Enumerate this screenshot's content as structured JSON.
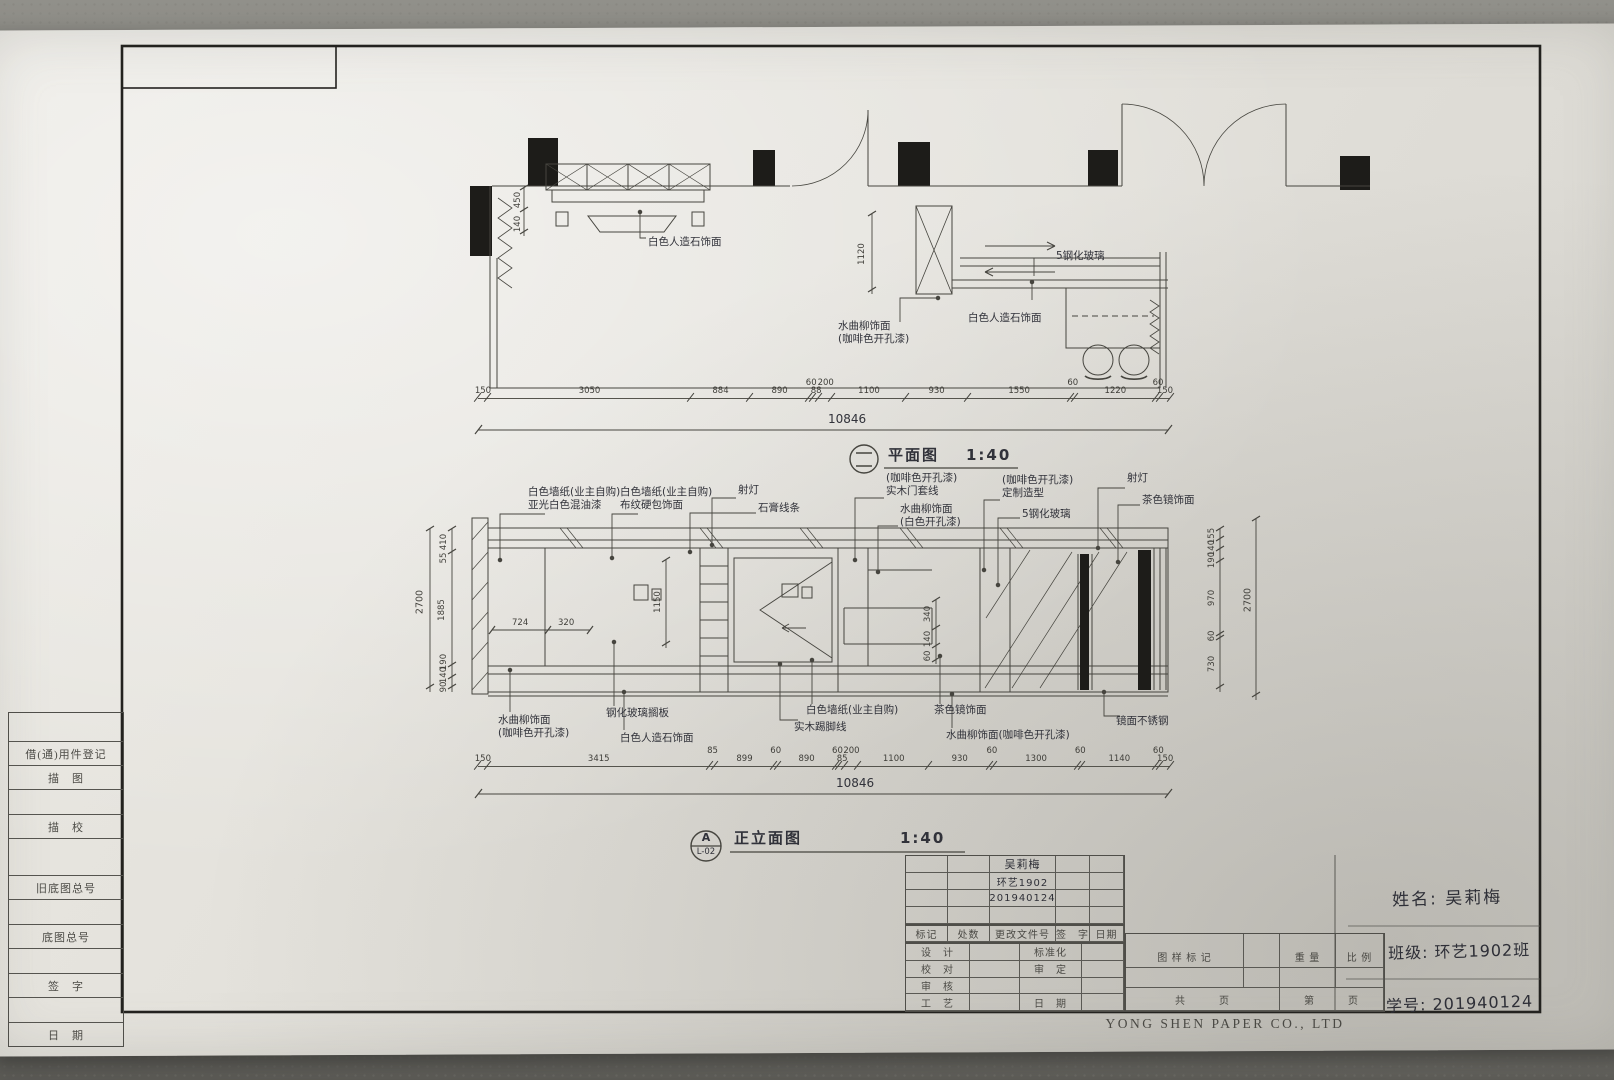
{
  "margin_table": {
    "rows": [
      "借(通)用件登记",
      "描　图",
      "描　校",
      "旧底图总号",
      "底图总号",
      "签　字",
      "日　期"
    ]
  },
  "plan": {
    "title": "平面图",
    "scale": "1:40",
    "annotations": [
      "白色人造石饰面",
      "水曲柳饰面\n(咖啡色开孔漆)",
      "白色人造石饰面",
      "5钢化玻璃"
    ],
    "dims": [
      "150",
      "3050",
      "884",
      "890",
      "60",
      "88",
      "200",
      "1100",
      "930",
      "1550",
      "60",
      "1220",
      "60",
      "150"
    ],
    "total": "10846",
    "v_dim": "1120",
    "left_dims": [
      "450",
      "140"
    ]
  },
  "elevation": {
    "title": "正立面图",
    "scale": "1:40",
    "ref_letter": "A",
    "ref_sheet": "L-02",
    "top_annotations": [
      "白色墙纸(业主自购)\n亚光白色混油漆",
      "白色墙纸(业主自购)\n布纹硬包饰面",
      "射灯",
      "石膏线条",
      "(咖啡色开孔漆)\n实木门套线",
      "水曲柳饰面\n(白色开孔漆)",
      "(咖啡色开孔漆)\n定制造型",
      "5钢化玻璃",
      "射灯",
      "茶色镜饰面"
    ],
    "bottom_annotations": [
      "水曲柳饰面\n(咖啡色开孔漆)",
      "钢化玻璃搁板",
      "白色人造石饰面",
      "白色墙纸(业主自购)",
      "实木踢脚线",
      "茶色镜饰面",
      "水曲柳饰面(咖啡色开孔漆)",
      "镜面不锈钢"
    ],
    "dims": [
      "150",
      "3415",
      "85",
      "899",
      "60",
      "890",
      "60",
      "85",
      "200",
      "1100",
      "930",
      "60",
      "1300",
      "60",
      "1140",
      "60",
      "150"
    ],
    "total": "10846",
    "left_dims": [
      "410",
      "55",
      "1885",
      "190",
      "140",
      "90"
    ],
    "left_overall": "2700",
    "right_dims": [
      "155",
      "140",
      "190",
      "970",
      "60",
      "730"
    ],
    "right_overall": "2700",
    "interior_dims": {
      "niche": "1150",
      "shelf_a": "724",
      "shelf_b": "320",
      "tv_a": "340",
      "tv_b": "140",
      "tv_c": "60"
    }
  },
  "title_block": {
    "change_header": [
      "标记",
      "处数",
      "更改文件号",
      "签　字",
      "日期"
    ],
    "left_rows": [
      "设　计",
      "校　对",
      "审　核",
      "工　艺"
    ],
    "mid_rows": [
      "标准化",
      "审　定",
      "日　期"
    ],
    "stamp_label": "图 样 标 记",
    "weight_label": "重 量",
    "scale_label": "比 例",
    "pages_total": "共　　　页",
    "pages_no": "第　　　页",
    "hw_name": "吴莉梅",
    "hw_class": "环艺1902",
    "hw_id": "201940124",
    "name_line": "姓名: 吴莉梅",
    "class_line": "班级: 环艺1902班",
    "id_line": "学号: 201940124"
  },
  "footer": "YONG SHEN PAPER CO., LTD"
}
